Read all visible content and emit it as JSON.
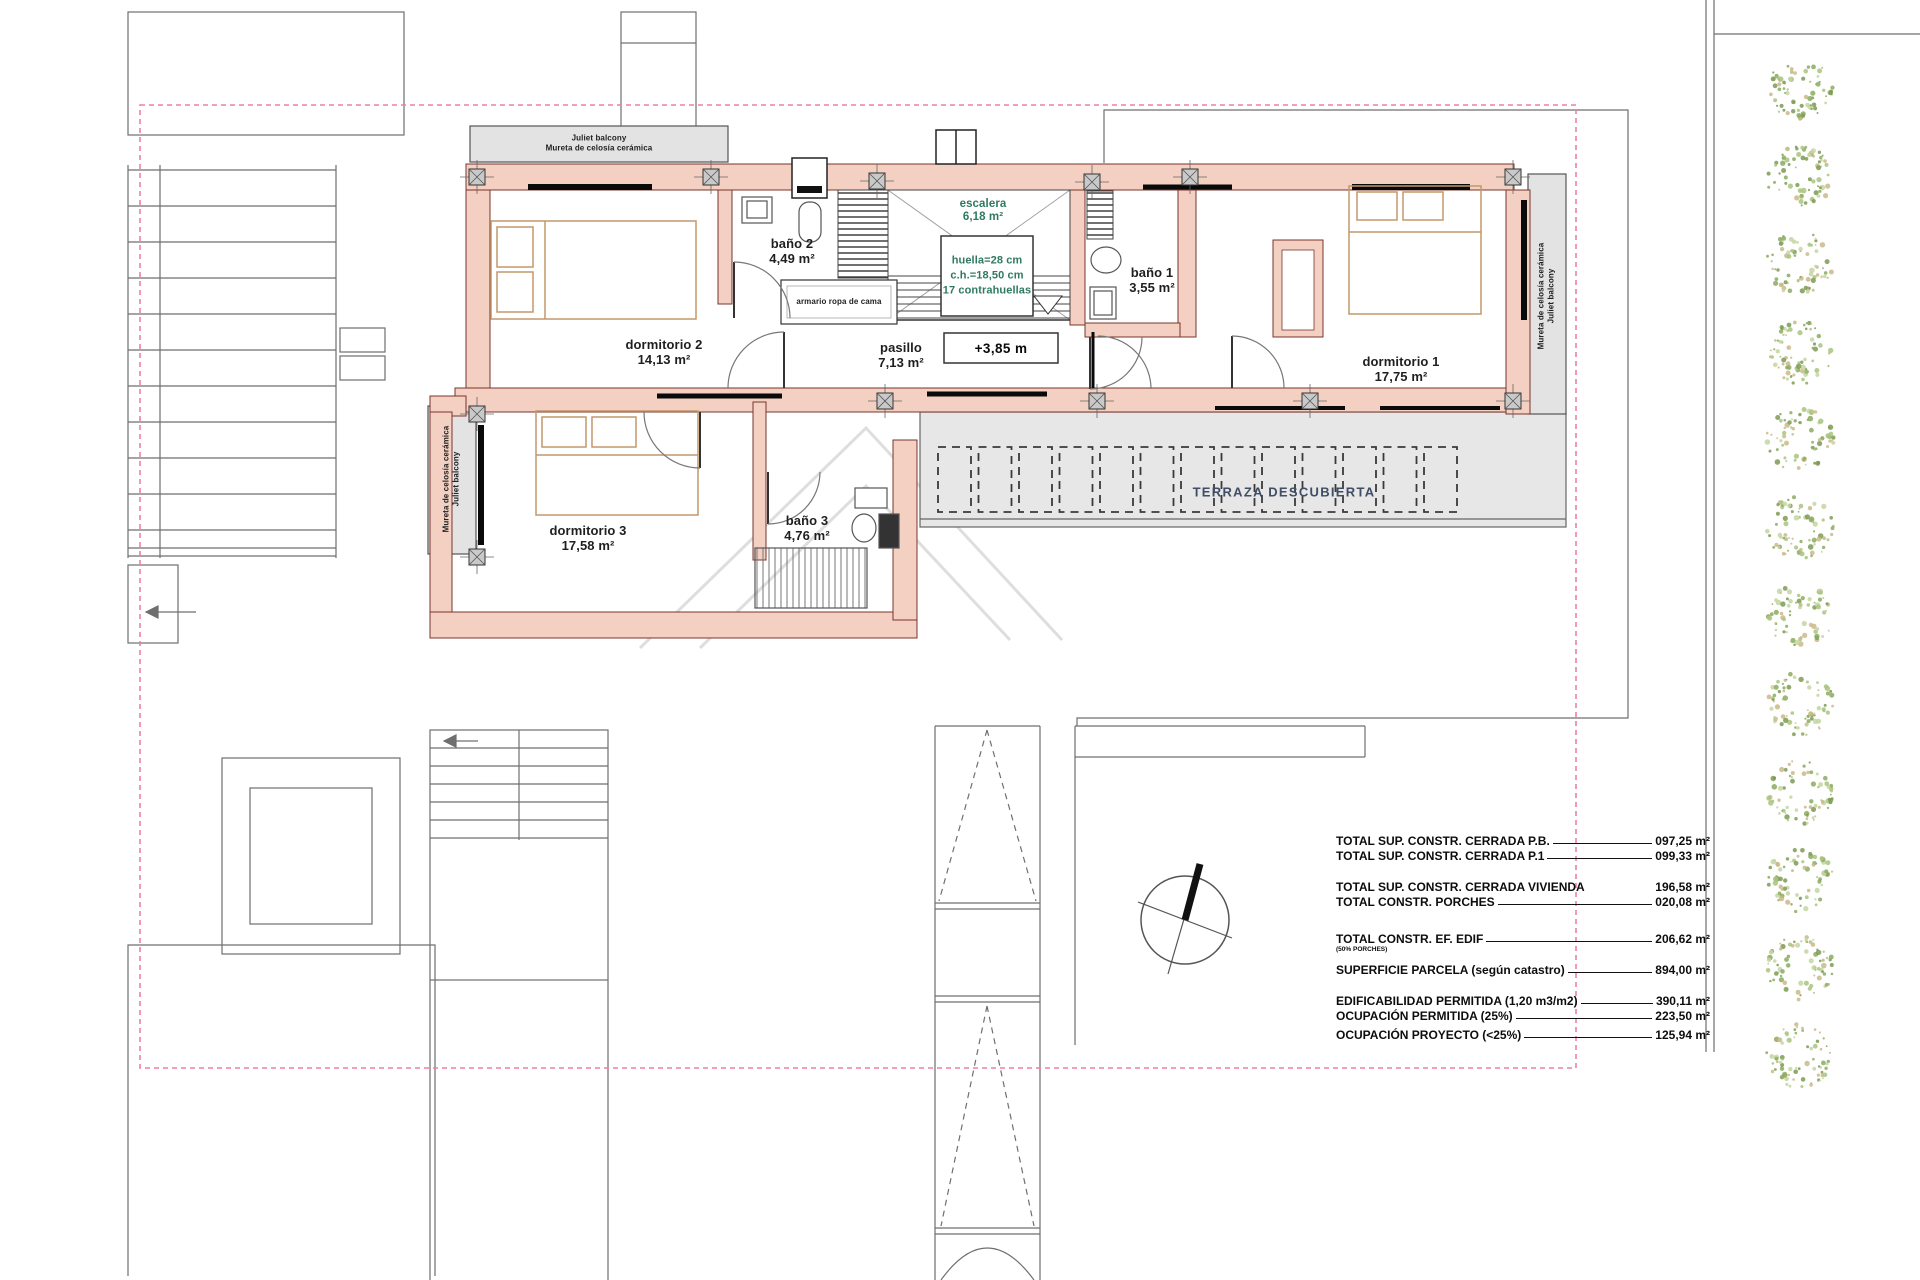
{
  "rooms": {
    "dormitorio1": {
      "name": "dormitorio 1",
      "area": "17,75 m²"
    },
    "dormitorio2": {
      "name": "dormitorio 2",
      "area": "14,13 m²"
    },
    "dormitorio3": {
      "name": "dormitorio 3",
      "area": "17,58 m²"
    },
    "bano1": {
      "name": "baño 1",
      "area": "3,55 m²"
    },
    "bano2": {
      "name": "baño 2",
      "area": "4,49 m²"
    },
    "bano3": {
      "name": "baño 3",
      "area": "4,76 m²"
    },
    "pasillo": {
      "name": "pasillo",
      "area": "7,13 m²"
    },
    "escalera": {
      "name": "escalera",
      "area": "6,18 m²"
    },
    "terraza": {
      "name": "TERRAZA DESCUBIERTA"
    }
  },
  "annotations": {
    "stair_note_1": "huella=28 cm",
    "stair_note_2": "c.h.=18,50 cm",
    "stair_note_3": "17 contrahuellas",
    "level": "+3,85 m",
    "closet": "armario ropa de cama",
    "balcony_top_1": "Juliet balcony",
    "balcony_top_2": "Mureta de celosía cerámica",
    "balcony_side_1": "Mureta de celosía cerámica",
    "balcony_side_2": "Juliet balcony"
  },
  "legend": {
    "rows": [
      {
        "label": "TOTAL SUP. CONSTR. CERRADA P.B.",
        "value": "097,25 m²"
      },
      {
        "label": "TOTAL SUP. CONSTR. CERRADA P.1",
        "value": "099,33 m²"
      },
      {
        "label": "TOTAL SUP. CONSTR. CERRADA VIVIENDA",
        "value": "196,58 m²"
      },
      {
        "label": "TOTAL  CONSTR. PORCHES",
        "value": "020,08 m²"
      },
      {
        "label": "TOTAL  CONSTR.  EF. EDIF",
        "value": "206,62 m²",
        "note": "(50% PORCHES)"
      },
      {
        "label": "SUPERFICIE PARCELA (según catastro)",
        "value": "894,00 m²"
      },
      {
        "label": "EDIFICABILIDAD PERMITIDA (1,20 m3/m2)",
        "value": "390,11 m²"
      },
      {
        "label": "OCUPACIÓN PERMITIDA (25%)",
        "value": "223,50 m²"
      },
      {
        "label": "OCUPACIÓN PROYECTO (<25%)",
        "value": "125,94 m²"
      }
    ]
  },
  "trees": {
    "count": 12
  },
  "colors": {
    "wall_fill": "#f3d0c2",
    "wall_stroke": "#7a352c",
    "boundary_dash": "#ef7fa6",
    "terrace_fill": "#e7e7e7",
    "balcony_fill": "#e3e3e3",
    "stair_note_green": "#2f7a5f",
    "terrace_text": "#3f4e66",
    "furniture_tan": "#c2996b"
  },
  "tree_palette": [
    "#a9c47f",
    "#8aab5f",
    "#c4d6a2",
    "#7d9a54",
    "#cbb98a"
  ]
}
